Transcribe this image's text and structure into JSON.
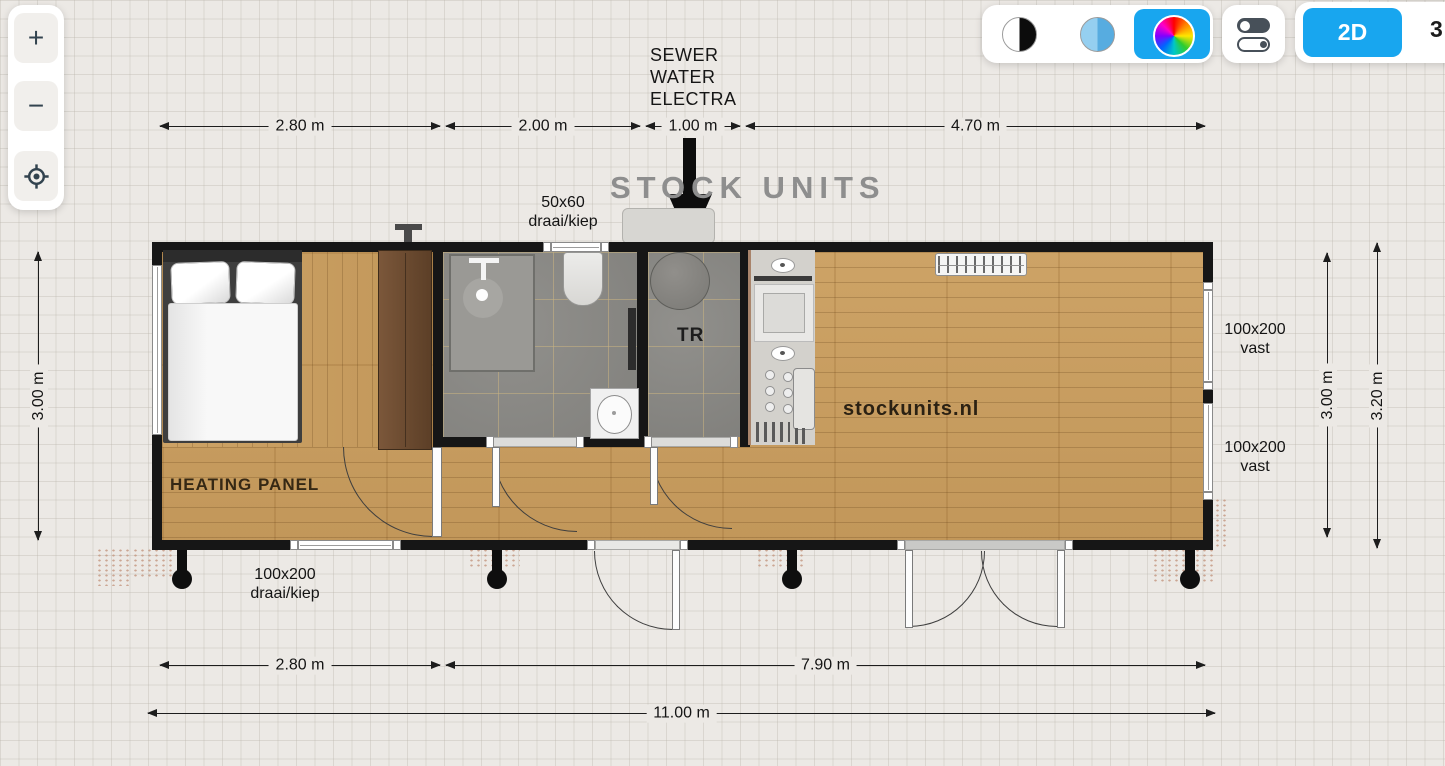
{
  "zoom_controls": {
    "zoom_in": "+",
    "zoom_out": "−"
  },
  "view_toolbar": {
    "mode_2d": "2D",
    "mode_3d_partial": "3"
  },
  "plan": {
    "watermark": "STOCK UNITS",
    "brand": "stockunits.nl",
    "utilities_label": {
      "l1": "SEWER",
      "l2": "WATER",
      "l3": "ELECTRA"
    },
    "room_labels": {
      "heating_panel": "HEATING PANEL",
      "technical_room": "TR"
    },
    "window_labels": {
      "top": {
        "l1": "50x60",
        "l2": "draai/kiep"
      },
      "bottom": {
        "l1": "100x200",
        "l2": "draai/kiep"
      },
      "right_upper": {
        "l1": "100x200",
        "l2": "vast"
      },
      "right_lower": {
        "l1": "100x200",
        "l2": "vast"
      }
    },
    "dimensions": {
      "top": [
        "2.80 m",
        "2.00 m",
        "1.00 m",
        "4.70 m"
      ],
      "bottom_row1": [
        "2.80 m",
        "7.90 m"
      ],
      "bottom_row2": [
        "11.00 m"
      ],
      "left": [
        "3.00 m"
      ],
      "right": [
        "3.00 m",
        "3.20 m"
      ]
    },
    "colors": {
      "accent_blue": "#18a6ef",
      "wall": "#161616",
      "wood": "#c89d60",
      "tile": "#8b8a86"
    }
  }
}
